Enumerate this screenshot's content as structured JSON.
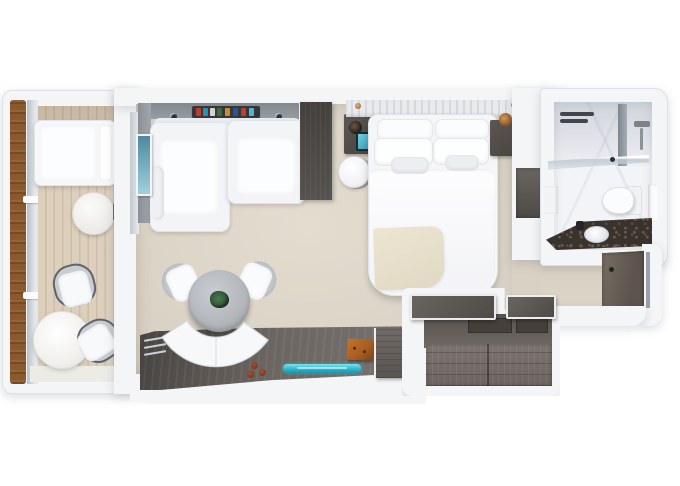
{
  "meta": {
    "title": "Suite floor plan, 3D top-down view",
    "visible_text": ""
  },
  "palette": {
    "background": "#ffffff",
    "wall": "#f4f5f7",
    "wall_edge": "#dde0e5",
    "floor": "#d9d1c4",
    "floor_light": "#e4dccf",
    "deck": "#d8cab5",
    "deck_stripe": "#c6b6a0",
    "wood_rail": "#8a5a2e",
    "dark_wood": "#4d4946",
    "drawer_wood": "#7b7470",
    "granite": "#3a322d",
    "marble": "#f3f4f7",
    "accent_teal": "#2fb7cf",
    "accent_orange": "#a85c20",
    "plant_green": "#2a4a32",
    "throw_beige": "#e0d8c2"
  },
  "rooms": [
    {
      "id": "balcony",
      "label": "Balcony",
      "furniture": [
        "lounger",
        "side table",
        "2 chairs",
        "round table"
      ]
    },
    {
      "id": "living",
      "label": "Living room",
      "furniture": [
        "sofa bed",
        "wardrobe",
        "dining table",
        "2 chairs",
        "curved bench",
        "console desk",
        "TV",
        "minibar cabinet"
      ]
    },
    {
      "id": "bedroom",
      "label": "Bedroom",
      "furniture": [
        "double bed",
        "6 pillows",
        "2 nightstands",
        "stool",
        "throw blanket"
      ]
    },
    {
      "id": "bathroom",
      "label": "Bathroom",
      "furniture": [
        "shower",
        "glass partition",
        "toilet",
        "vanity sink",
        "towel rack"
      ]
    },
    {
      "id": "entry",
      "label": "Entry hall",
      "furniture": [
        "entry door",
        "luggage bench",
        "dresser drawers",
        "shelf"
      ]
    }
  ],
  "items": {
    "lounger": "Sun lounger",
    "side_table": "Round side table",
    "balcony_chair": "Balcony chair",
    "cafe_table": "Balcony table",
    "railing": "Balcony railing",
    "sofa": "Sofa bed",
    "wardrobe": "Wardrobe cabinet",
    "wall_art": "Wall artwork",
    "book_shelf": "Shelf with books",
    "dining_table": "Round dining table",
    "plant": "Table plant",
    "dining_chair": "Dining chair",
    "bench": "Curved banquette",
    "console": "Console desk",
    "tv": "TV",
    "minibar": "Minibar cabinet",
    "bed": "Double bed",
    "headboard": "Headboard",
    "nightstand": "Nightstand",
    "stool": "Stool",
    "throw": "Throw blanket",
    "shower": "Shower",
    "glass": "Glass partition",
    "toilet": "Toilet",
    "vanity": "Vanity with sink",
    "towel": "Towel",
    "entry_door": "Entry door",
    "closet_bench": "Luggage bench",
    "drawers": "Dresser drawers",
    "shelf": "Closet shelf"
  }
}
